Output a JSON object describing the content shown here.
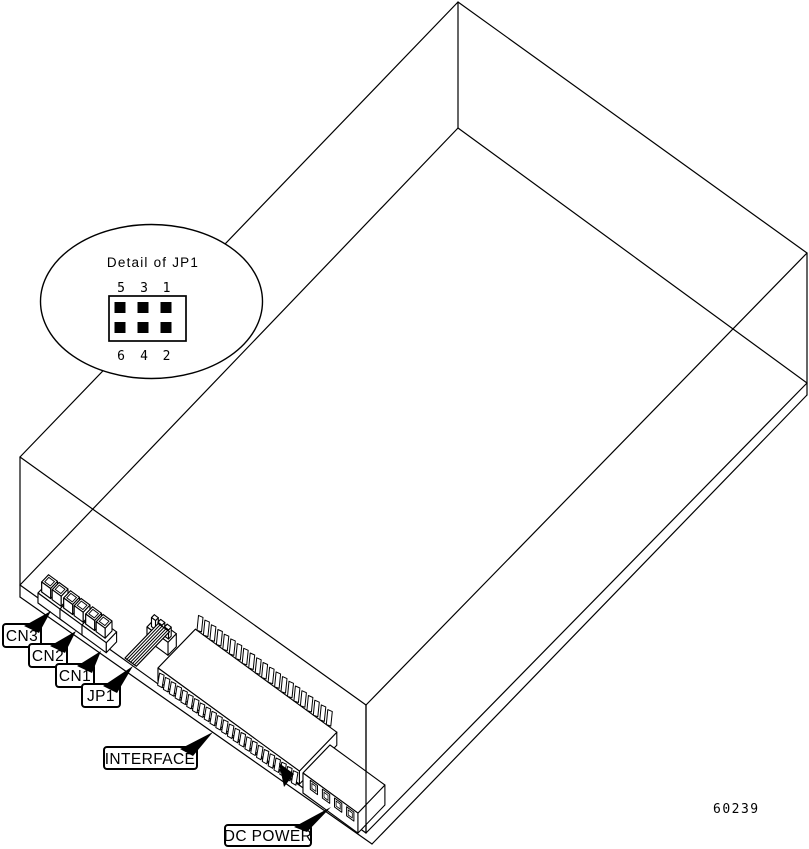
{
  "figure": {
    "drawing_number": "60239"
  },
  "detail_callout": {
    "title": "Detail of JP1",
    "top_pins": [
      "5",
      "3",
      "1"
    ],
    "bottom_pins": [
      "6",
      "4",
      "2"
    ]
  },
  "labels": {
    "cn3": "CN3",
    "cn2": "CN2",
    "cn1": "CN1",
    "jp1": "JP1",
    "interface": "INTERFACE",
    "dc_power": "DC POWER"
  },
  "colors": {
    "line": "#000000",
    "background": "#ffffff",
    "fill": "#ffffff"
  }
}
